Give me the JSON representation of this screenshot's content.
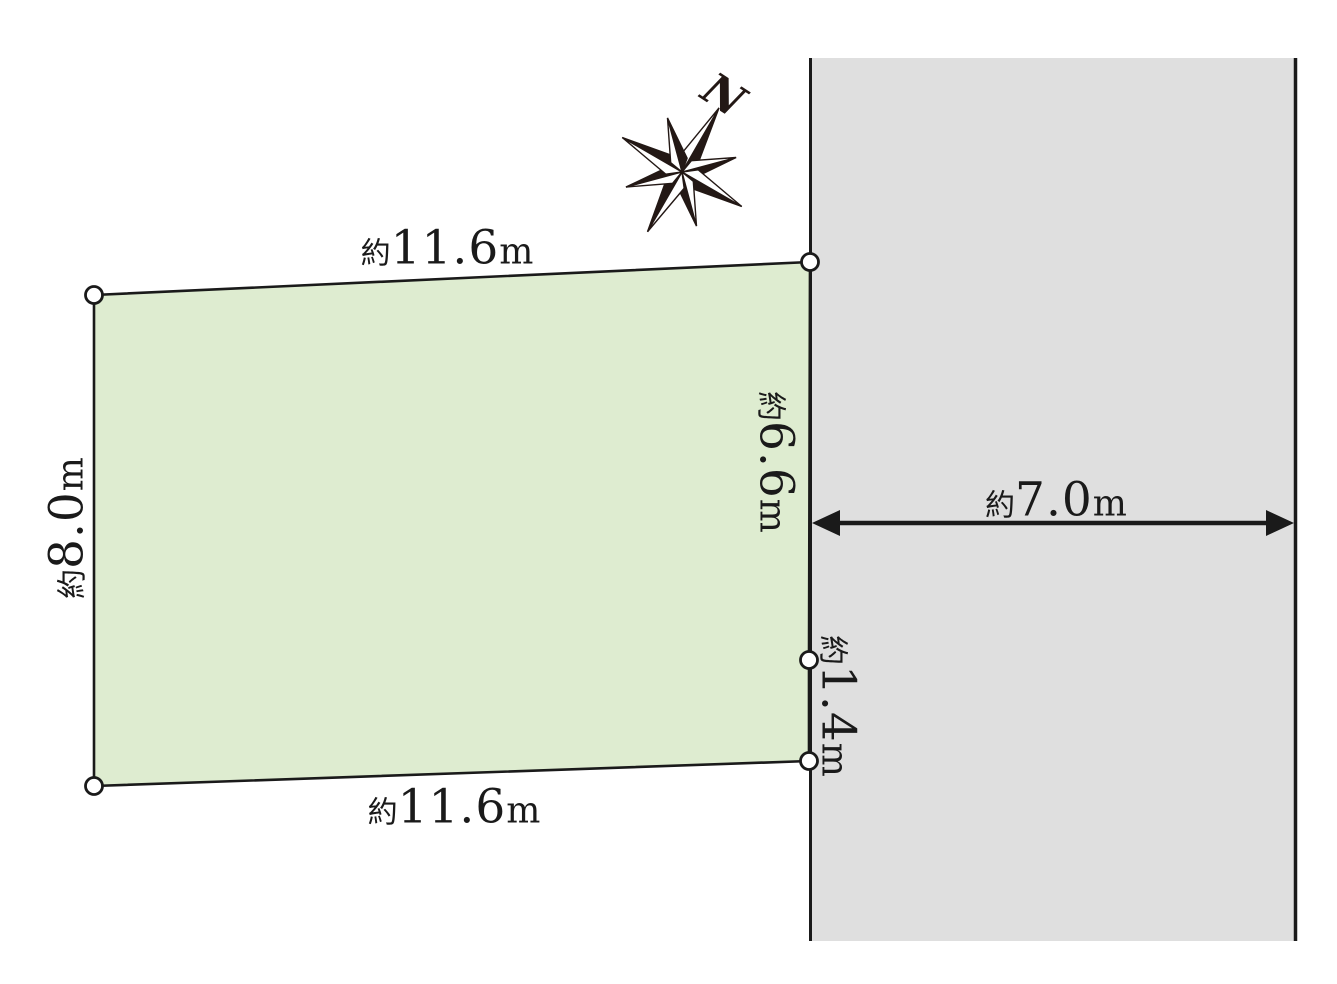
{
  "diagram": {
    "type": "land-plot-site-plan",
    "compass_label": "N",
    "labels": {
      "top_edge": {
        "prefix": "約",
        "value": "11.6",
        "unit": "m"
      },
      "bottom_edge": {
        "prefix": "約",
        "value": "11.6",
        "unit": "m"
      },
      "left_edge": {
        "prefix": "約",
        "value": "8.0",
        "unit": "m"
      },
      "right_edge_upper": {
        "prefix": "約",
        "value": "6.6",
        "unit": "m"
      },
      "right_edge_lower": {
        "prefix": "約",
        "value": "1.4",
        "unit": "m"
      },
      "road_width": {
        "prefix": "約",
        "value": "7.0",
        "unit": "m"
      }
    },
    "colors": {
      "parcel_fill": "#deecd0",
      "road_fill": "#dfdfdf",
      "line": "#1a1a1a",
      "compass": "#231815"
    }
  }
}
